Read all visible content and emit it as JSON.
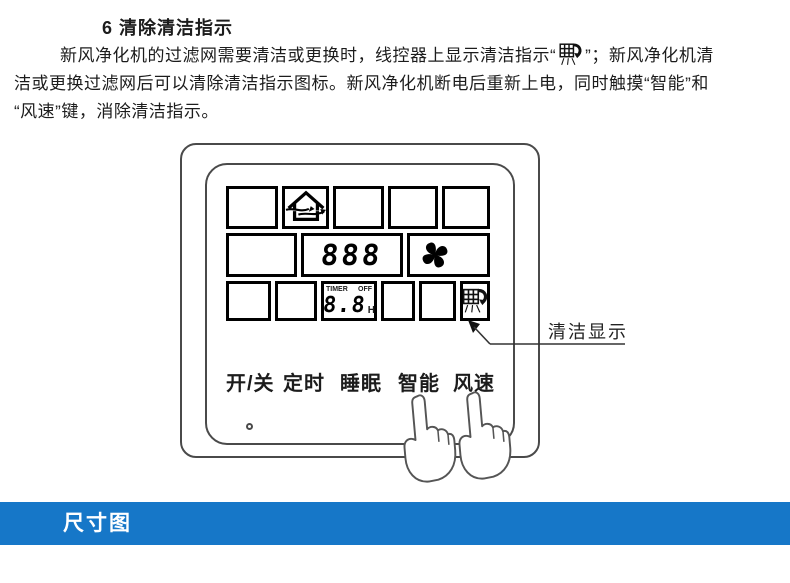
{
  "instructions": {
    "heading": "6 清除清洁指示",
    "lines": [
      {
        "before": "新风净化机的过滤网需要清洁或更换时，线控器上显示清洁指示“",
        "after": "”；新风净化机清"
      },
      {
        "text": "洁或更换过滤网后可以清除清洁指示图标。新风净化机断电后重新上电，同时触摸“智能”和"
      },
      {
        "text": "“风速”键，消除清洁指示。"
      }
    ]
  },
  "controller": {
    "display": {
      "main_digits": "888",
      "timer_label": "TIMER",
      "off_label": "OFF",
      "timer_digits": "8.8",
      "timer_unit": "H"
    },
    "buttons": [
      {
        "label": "开/关"
      },
      {
        "label": "定时"
      },
      {
        "label": "睡眠"
      },
      {
        "label": "智能"
      },
      {
        "label": "风速"
      }
    ],
    "callout_label": "清洁显示",
    "icons": {
      "fresh_air": "fresh-air-house-icon",
      "fan": "fan-icon",
      "filter_clean": "filter-clean-icon",
      "hands": "pointing-hand-icon"
    }
  },
  "footer_banner": {
    "label": "尺寸图",
    "bg_color": "#1677c8",
    "text_color": "#ffffff"
  },
  "colors": {
    "text": "#1c1c1c",
    "line_art": "#4a4a4a",
    "lcd_border": "#000000",
    "background": "#ffffff"
  }
}
